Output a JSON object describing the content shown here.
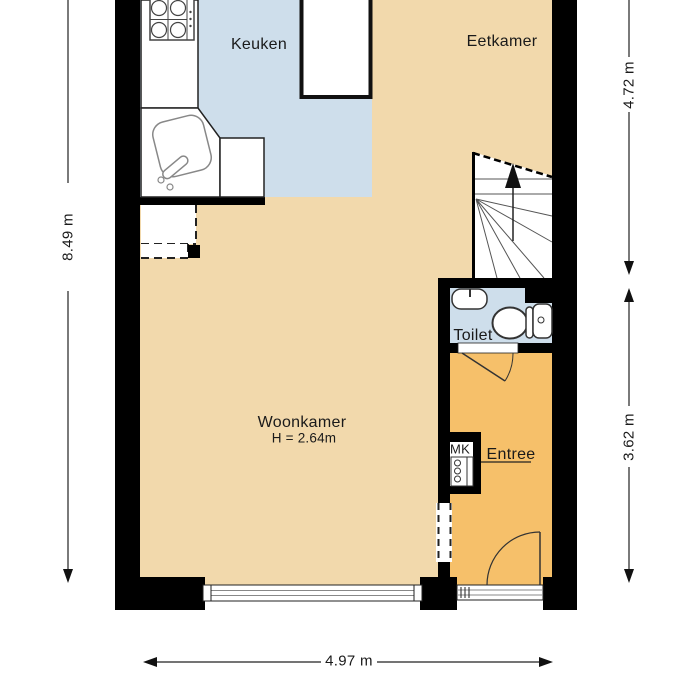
{
  "floorplan": {
    "rooms": {
      "keuken": {
        "label": "Keuken",
        "floor_color": "#cedeeb"
      },
      "eetkamer": {
        "label": "Eetkamer",
        "floor_color": "#f2d9ac"
      },
      "woonkamer": {
        "label": "Woonkamer",
        "ceiling_height": "H = 2.64m",
        "floor_color": "#f2d9ac"
      },
      "toilet": {
        "label": "Toilet",
        "floor_color": "#cedeeb"
      },
      "entree": {
        "label": "Entree",
        "floor_color": "#f6c06a"
      },
      "meterkast": {
        "label": "MK"
      }
    },
    "dimensions": {
      "left": "8.49 m",
      "right_top": "4.72 m",
      "right_bottom": "3.62 m",
      "bottom": "4.97 m"
    },
    "colors": {
      "wall": "#000000",
      "text": "#1a1a1a",
      "fixture_outline": "#555555",
      "glazing": "#888888"
    }
  }
}
